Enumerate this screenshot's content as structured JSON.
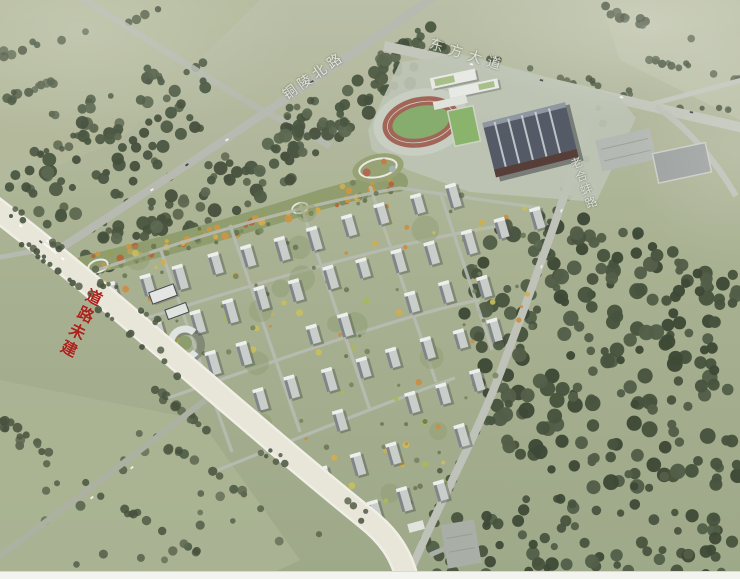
{
  "labels": {
    "road_north": {
      "text": "铜陵北路",
      "color": "#e8e8e0"
    },
    "road_avenue": {
      "text": "东方大道",
      "color": "#e6e6de"
    },
    "road_east": {
      "text": "老合蚌路",
      "color": "#e2e3da"
    },
    "road_unbuilt_note": {
      "text": "道路未建",
      "color": "#a8241c"
    }
  },
  "palette": {
    "field_green": "#a7b08f",
    "field_light": "#b4ba9c",
    "forest_dark": "#42503a",
    "park_green": "#8c9a6a",
    "autumn_orange": "#c9913b",
    "road_light": "#e9e7db",
    "road_gray": "#b9beb3",
    "building_face": "#c7ccc9",
    "building_side": "#7a8184",
    "track_red": "#9e6052",
    "pitch_green": "#82aa68",
    "dark_roof": "#4e5560"
  }
}
